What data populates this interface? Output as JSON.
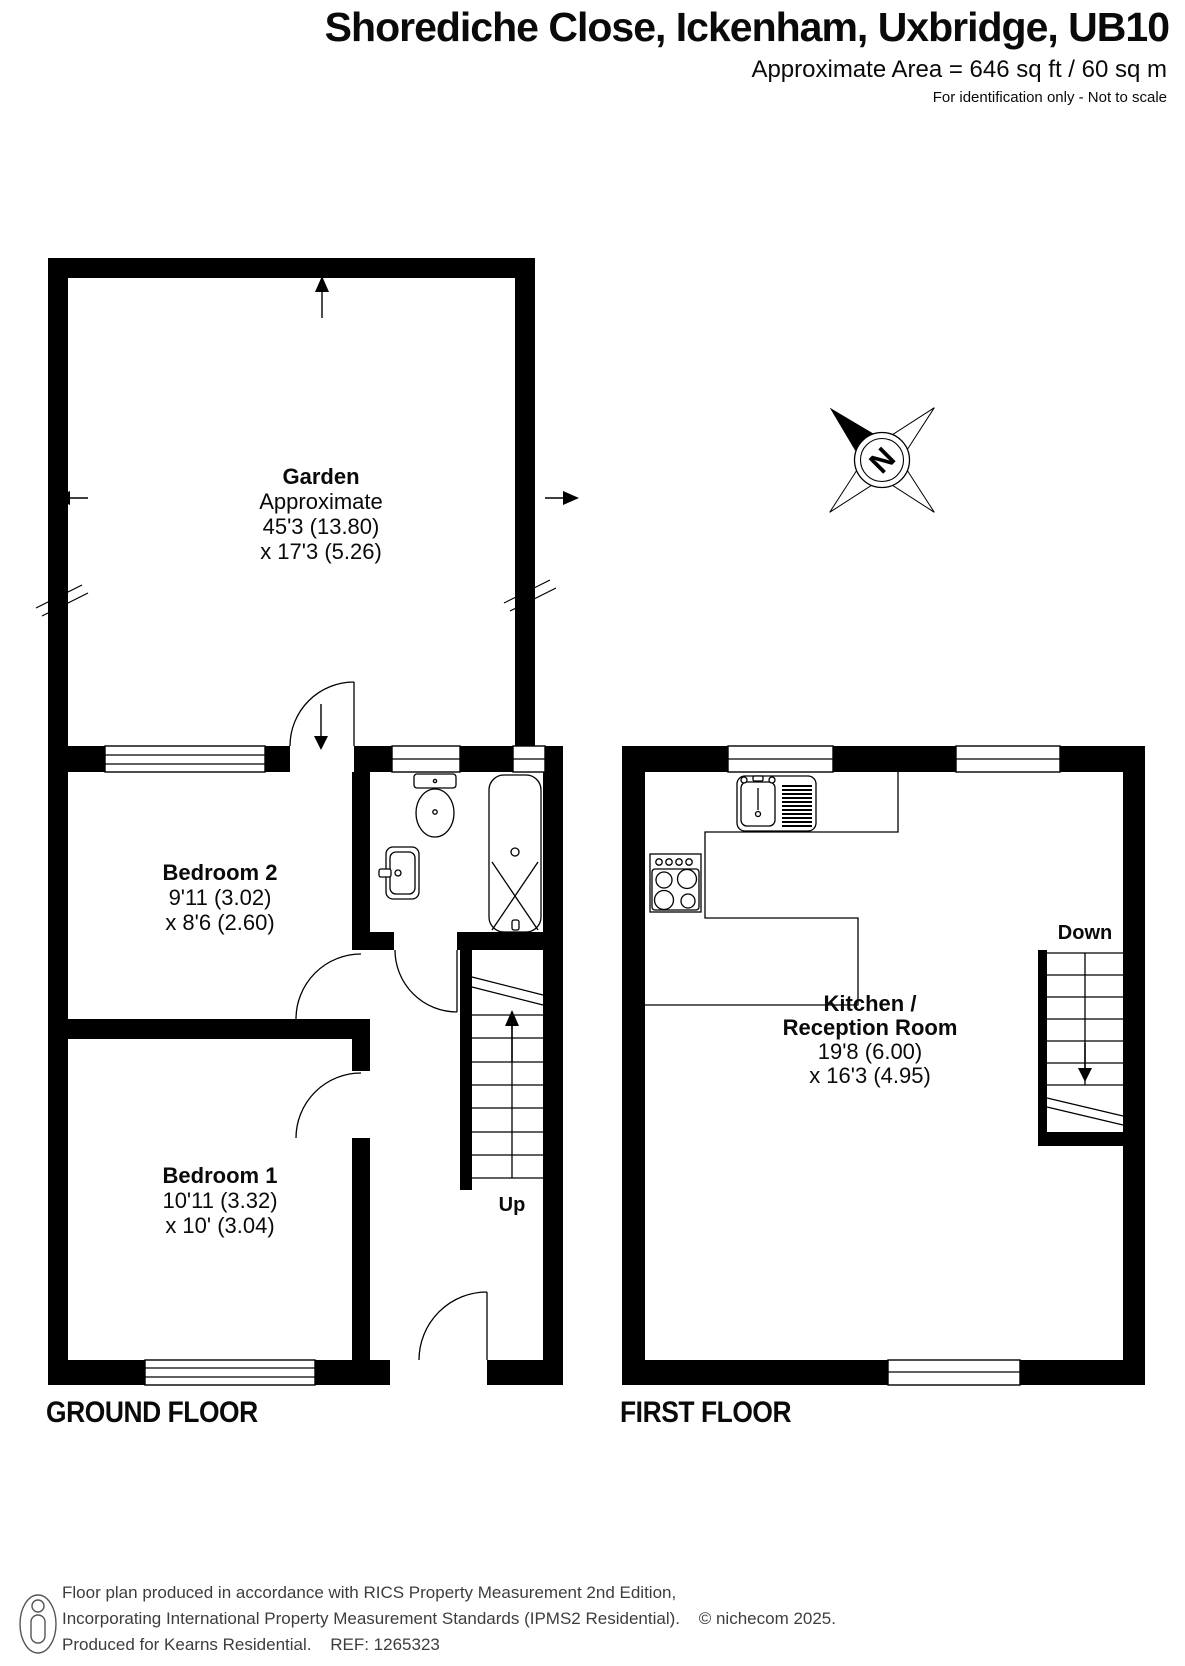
{
  "header": {
    "title": "Shorediche Close, Ickenham, Uxbridge, UB10",
    "area_line": "Approximate Area = 646 sq ft / 60 sq m",
    "disclaimer": "For identification only - Not to scale"
  },
  "compass": {
    "label": "N"
  },
  "ground_floor": {
    "floor_label": "GROUND FLOOR",
    "garden": {
      "name": "Garden",
      "line2": "Approximate",
      "dim1": "45'3 (13.80)",
      "dim2": "x 17'3 (5.26)"
    },
    "bedroom2": {
      "name": "Bedroom 2",
      "dim1": "9'11 (3.02)",
      "dim2": "x 8'6 (2.60)"
    },
    "bedroom1": {
      "name": "Bedroom 1",
      "dim1": "10'11 (3.32)",
      "dim2": "x 10' (3.04)"
    },
    "stairs_label": "Up"
  },
  "first_floor": {
    "floor_label": "FIRST FLOOR",
    "kitchen": {
      "name1": "Kitchen /",
      "name2": "Reception Room",
      "dim1": "19'8 (6.00)",
      "dim2": "x 16'3 (4.95)"
    },
    "stairs_label": "Down"
  },
  "footer": {
    "line1": "Floor plan produced in accordance with RICS Property Measurement 2nd Edition,",
    "line2": "Incorporating International Property Measurement Standards (IPMS2 Residential).",
    "copyright": "© nichecom 2025.",
    "line3": "Produced for Kearns Residential.",
    "ref": "REF: 1265323"
  }
}
